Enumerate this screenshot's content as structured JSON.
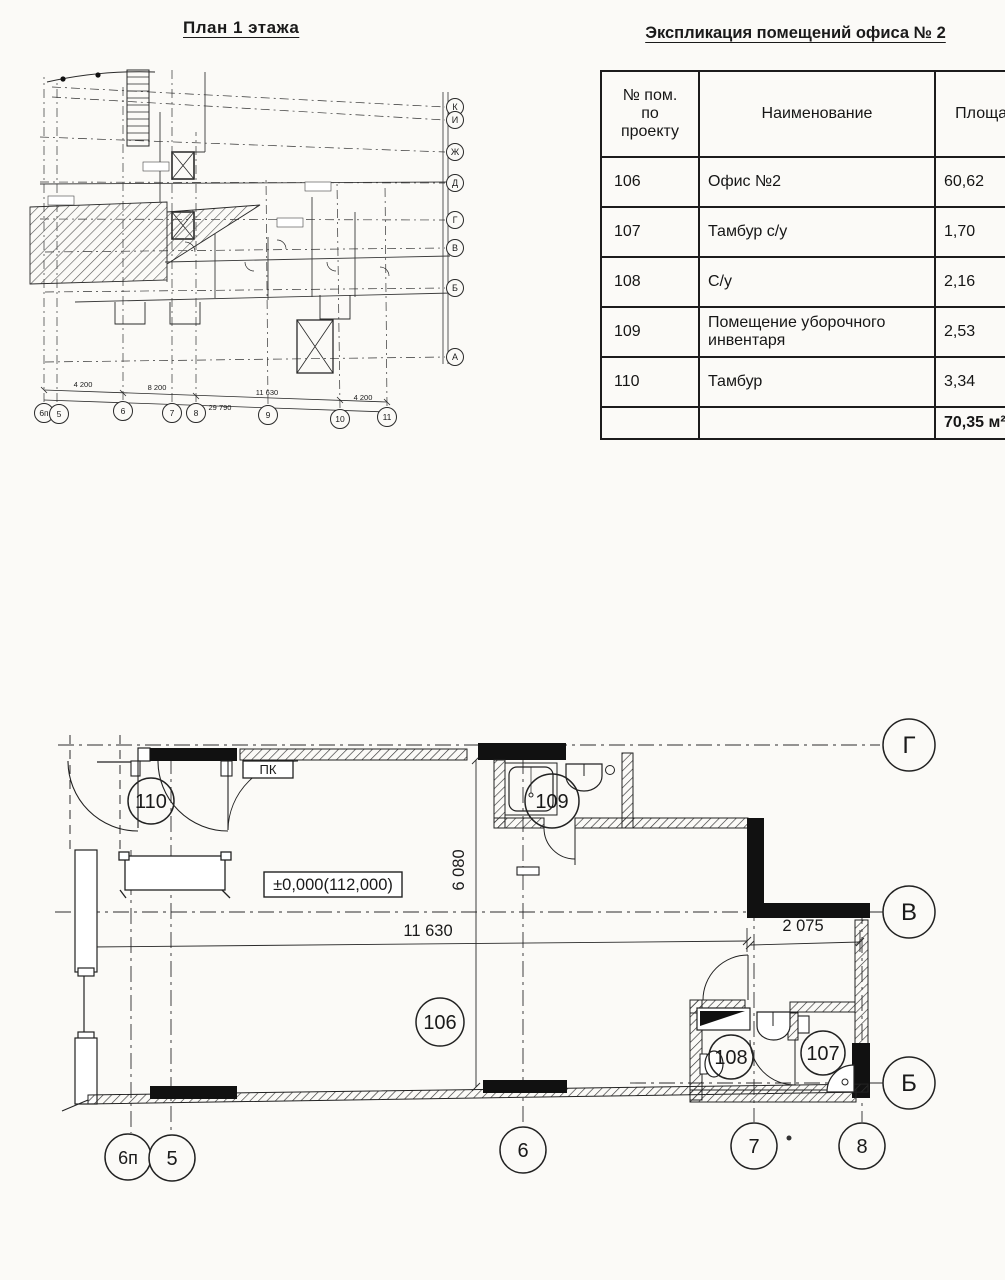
{
  "overview": {
    "title": "План 1 этажа",
    "axes_right": [
      "К",
      "И",
      "Ж",
      "Д",
      "Г",
      "В",
      "Б",
      "А"
    ],
    "axes_bottom": [
      "6п",
      "5",
      "6",
      "7",
      "8",
      "9",
      "10",
      "11"
    ],
    "dims": [
      "4 200",
      "8 200",
      "11 630",
      "4 200"
    ],
    "dim_total": "29 790"
  },
  "table": {
    "title": "Экспликация помещений офиса № 2",
    "columns": [
      "№ пом. по проекту",
      "Наименование",
      "Площадь"
    ],
    "rows": [
      {
        "num": "106",
        "name": "Офис №2",
        "area": "60,62"
      },
      {
        "num": "107",
        "name": "Тамбур с/у",
        "area": "1,70"
      },
      {
        "num": "108",
        "name": "С/у",
        "area": "2,16"
      },
      {
        "num": "109",
        "name": "Помещение уборочного инвентаря",
        "area": "2,53"
      },
      {
        "num": "110",
        "name": "Тамбур",
        "area": "3,34"
      }
    ],
    "total": "70,35 м²"
  },
  "plan": {
    "room_110": "110",
    "room_109": "109",
    "room_106": "106",
    "room_108": "108",
    "room_107": "107",
    "axis_g": "Г",
    "axis_v": "В",
    "axis_b": "Б",
    "grid_6p": "6п",
    "grid_5": "5",
    "grid_6": "6",
    "grid_7": "7",
    "grid_8": "8",
    "dim_main": "11 630",
    "dim_right": "2 075",
    "dim_vert": "6 080",
    "elevation": "±0,000(112,000)",
    "pk": "ПК"
  }
}
